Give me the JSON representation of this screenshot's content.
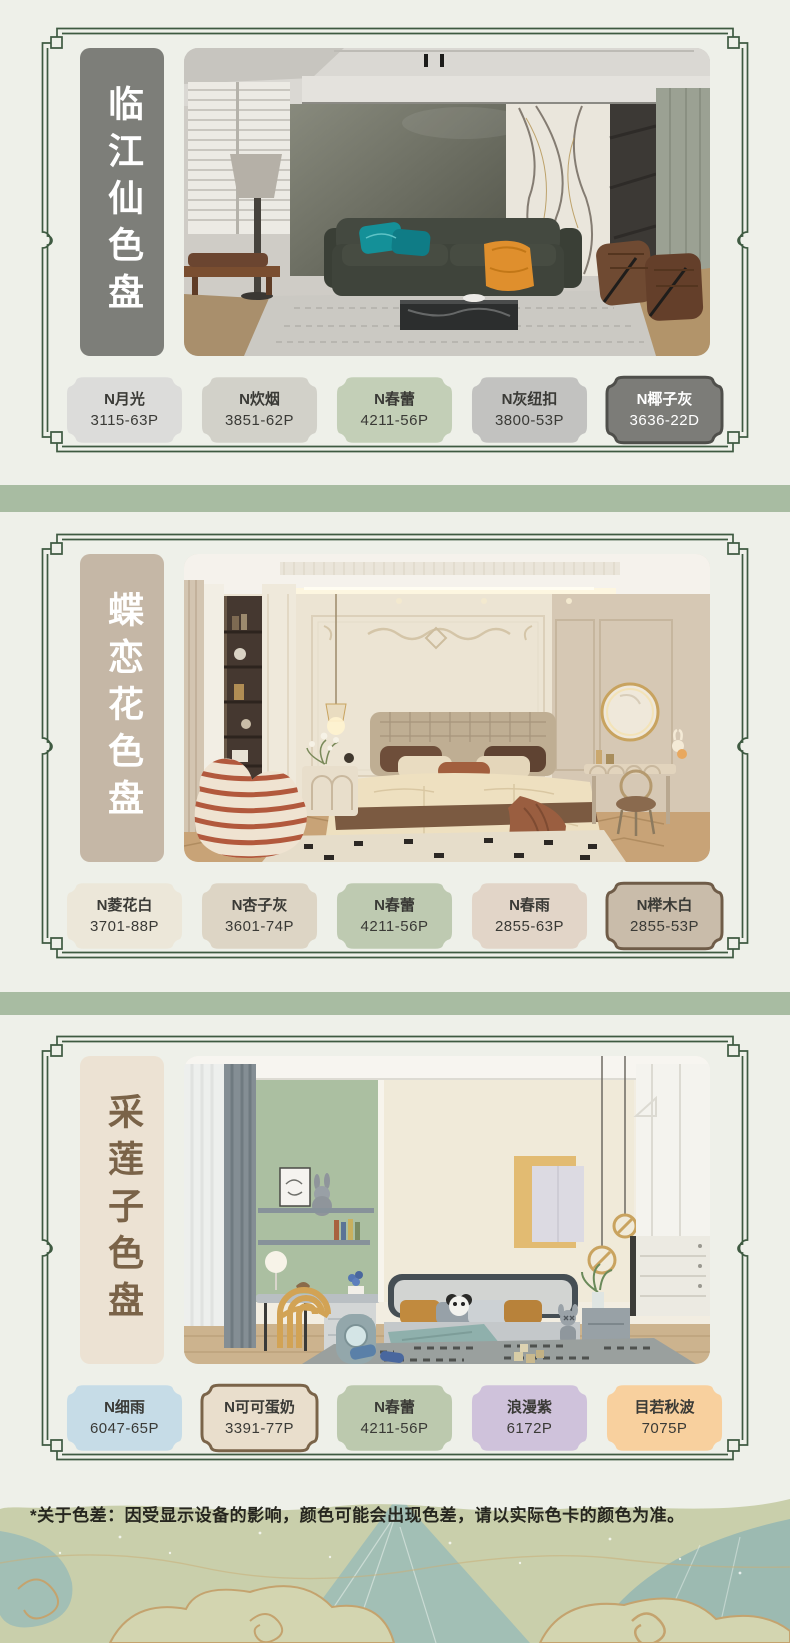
{
  "page": {
    "bg": "#eef0e9",
    "band_color": "#a8bca2",
    "frame_color": "#3e5a41",
    "disclaimer": "*关于色差：因受显示设备的影响，颜色可能会出现色差，请以实际色卡的颜色为准。"
  },
  "cards": [
    {
      "title": "临江仙色盘",
      "title_bg": "#7d7e79",
      "title_color": "#ffffff",
      "photo": "modern-living-room",
      "swatches": [
        {
          "name": "N月光",
          "code": "3115-63P",
          "fill": "#dcdcda",
          "text": "#3a3a36",
          "border": null
        },
        {
          "name": "N炊烟",
          "code": "3851-62P",
          "fill": "#d2d1c9",
          "text": "#3a3a36",
          "border": null
        },
        {
          "name": "N春蕾",
          "code": "4211-56P",
          "fill": "#c3cfb7",
          "text": "#3a3a36",
          "border": null
        },
        {
          "name": "N灰纽扣",
          "code": "3800-53P",
          "fill": "#c2c2c0",
          "text": "#3a3a36",
          "border": null
        },
        {
          "name": "N椰子灰",
          "code": "3636-22D",
          "fill": "#7c7c78",
          "text": "#ffffff",
          "border": "#4f4f4b"
        }
      ]
    },
    {
      "title": "蝶恋花色盘",
      "title_bg": "#c5b7a6",
      "title_color": "#ffffff",
      "photo": "french-cream-bedroom",
      "swatches": [
        {
          "name": "N菱花白",
          "code": "3701-88P",
          "fill": "#ece7d9",
          "text": "#3a3a36",
          "border": null
        },
        {
          "name": "N杏子灰",
          "code": "3601-74P",
          "fill": "#ddd5c5",
          "text": "#3a3a36",
          "border": null
        },
        {
          "name": "N春蕾",
          "code": "4211-56P",
          "fill": "#becab1",
          "text": "#3a3a36",
          "border": null
        },
        {
          "name": "N春雨",
          "code": "2855-63P",
          "fill": "#e2d5c8",
          "text": "#3a3a36",
          "border": null
        },
        {
          "name": "N榉木白",
          "code": "2855-53P",
          "fill": "#c9bcaa",
          "text": "#3a3a36",
          "border": "#6f5c48"
        }
      ]
    },
    {
      "title": "采莲子色盘",
      "title_bg": "#ece2d3",
      "title_color": "#7a6348",
      "photo": "kids-bedroom",
      "swatches": [
        {
          "name": "N细雨",
          "code": "6047-65P",
          "fill": "#c6dce7",
          "text": "#3a3a36",
          "border": null
        },
        {
          "name": "N可可蛋奶",
          "code": "3391-77P",
          "fill": "#e9decc",
          "text": "#3a3a36",
          "border": "#7a6449"
        },
        {
          "name": "N春蕾",
          "code": "4211-56P",
          "fill": "#bcc9ae",
          "text": "#3a3a36",
          "border": null
        },
        {
          "name": "浪漫紫",
          "code": "6172P",
          "fill": "#cfc2db",
          "text": "#3a3a36",
          "border": null
        },
        {
          "name": "目若秋波",
          "code": "7075P",
          "fill": "#f8d09e",
          "text": "#3a3a36",
          "border": null
        }
      ]
    }
  ]
}
